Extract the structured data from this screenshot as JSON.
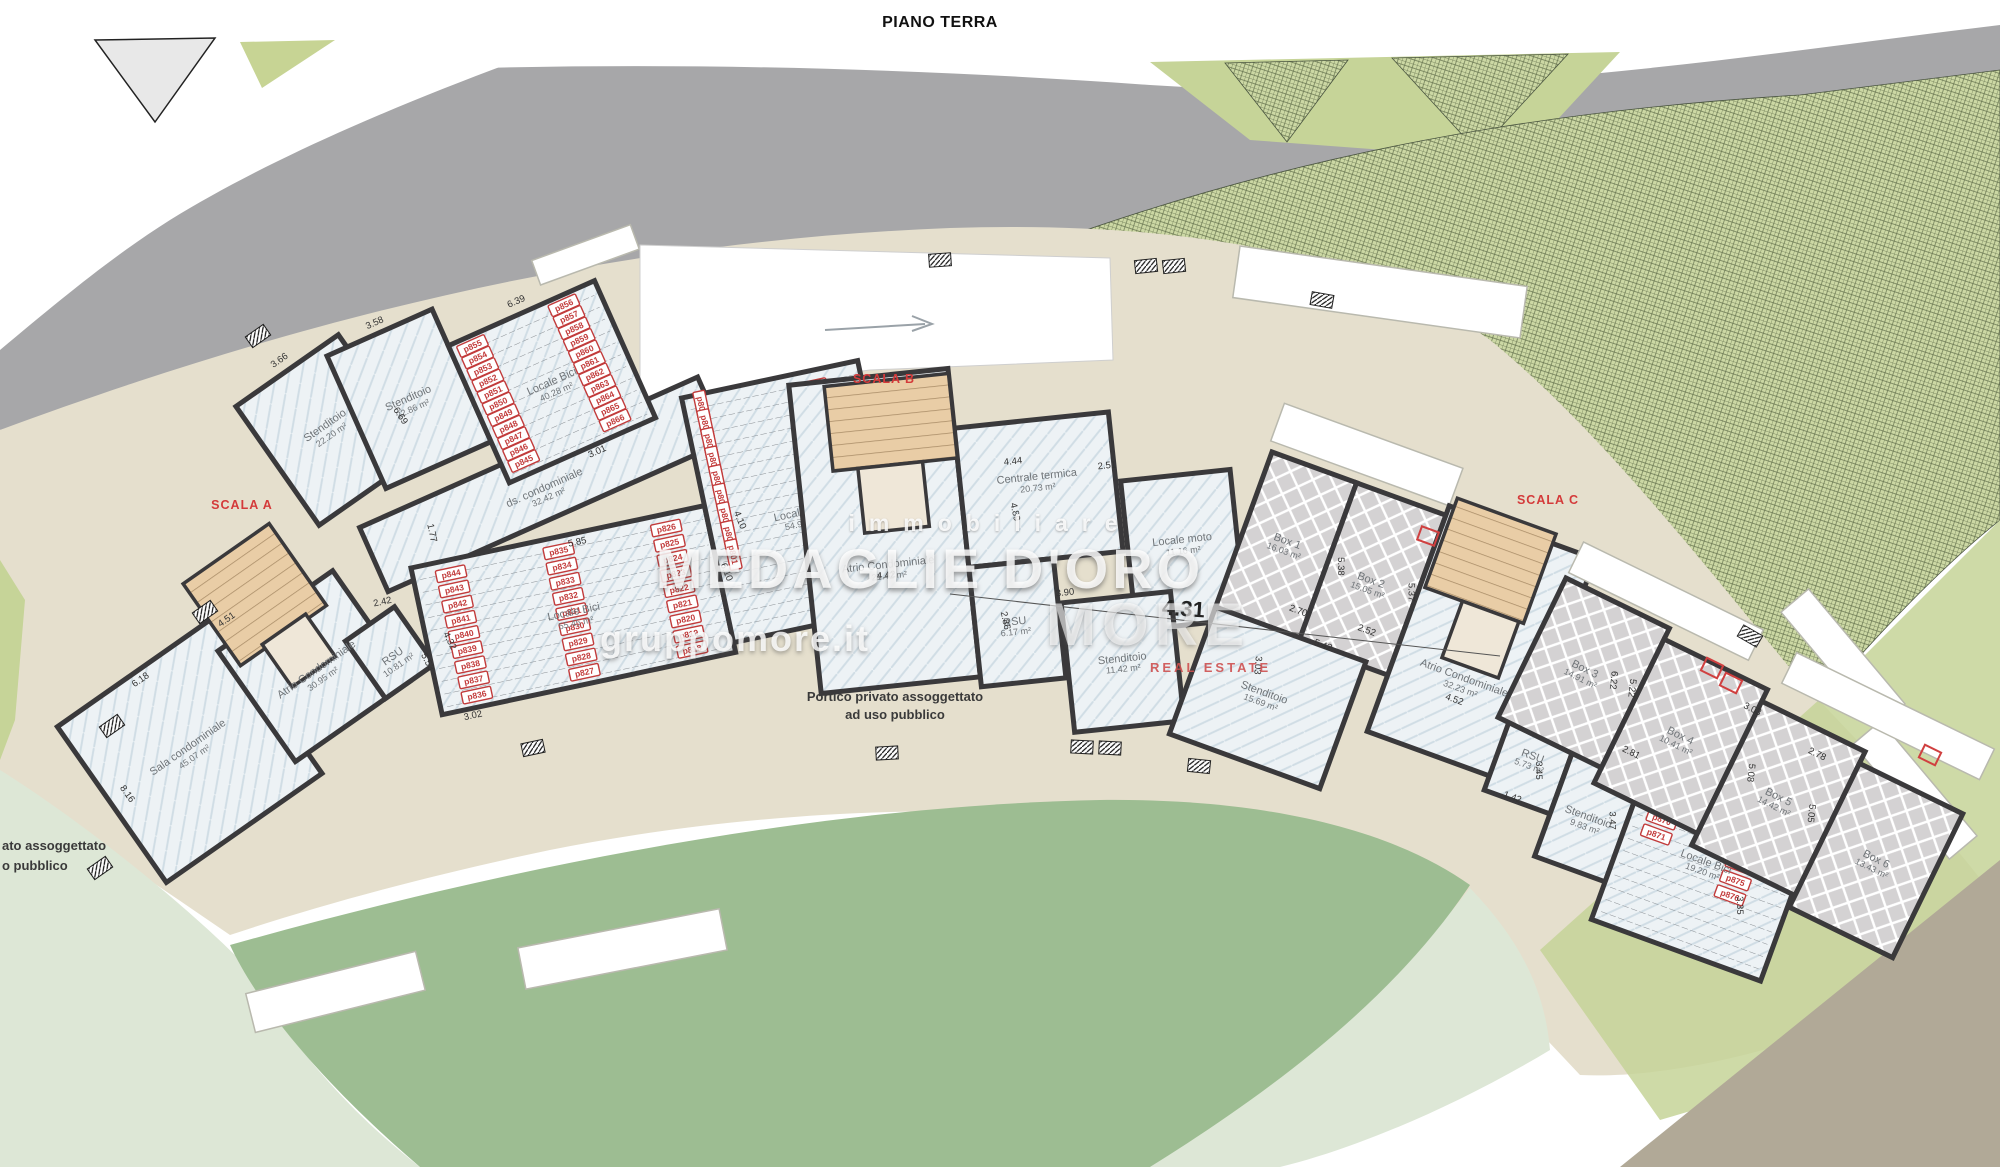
{
  "title": "PIANO TERRA",
  "stairwells": {
    "a": "SCALA A",
    "b": "SCALA B",
    "c": "SCALA C"
  },
  "watermark": {
    "immobiliare": "immobiliare",
    "brand": "MEDAGLIE D'ORO",
    "site": "gruppomore.it",
    "more": "MORE",
    "real_estate": "REAL ESTATE"
  },
  "annotations": {
    "portico_line1": "Portico privato assoggettato",
    "portico_line2": "ad uso pubblico",
    "edge_line1": "ato assoggettato",
    "edge_line2": "o pubblico",
    "big_dim": "4.31"
  },
  "colors": {
    "road_gray": "#a7a7a9",
    "lawn_light": "#dde7d6",
    "lawn_medium": "#9dbd92",
    "garden_green": "#ccd8a4",
    "pavement_tan": "#e5dfcd",
    "road_brown": "#b1a997",
    "wall": "#3a393b",
    "accent_red": "#d43a3a"
  },
  "rooms": {
    "sala": {
      "name": "Sala condominiale",
      "area": "45.07 m²"
    },
    "atrioA": {
      "name": "Atrio Condominiale",
      "area": "30.95 m²"
    },
    "rsu1081": {
      "name": "RSU",
      "area": "10.81 m²"
    },
    "stend2220": {
      "name": "Stenditoio",
      "area": "22.20 m²"
    },
    "stend2286": {
      "name": "Stenditoio",
      "area": "22.86 m²"
    },
    "bici4028": {
      "name": "Locale Bici",
      "area": "40.28 m²"
    },
    "dscond": {
      "name": "ds. condominiale",
      "area": "32.42 m²"
    },
    "bici5545": {
      "name": "Locale Bici",
      "area": "55.45 m²"
    },
    "bici5497": {
      "name": "Locale Bici",
      "area": "54.97 m²"
    },
    "atrioB": {
      "name": "Atrio Condominiale",
      "area": "21.42 m²"
    },
    "centrale": {
      "name": "Centrale termica",
      "area": "20.73 m²"
    },
    "moto": {
      "name": "Locale moto",
      "area": "11.16 m²"
    },
    "rsu617": {
      "name": "RSU",
      "area": "6.17 m²"
    },
    "stend1142": {
      "name": "Stenditoio",
      "area": "11.42 m²"
    },
    "box1": {
      "name": "Box 1",
      "area": "16.03 m²"
    },
    "box2": {
      "name": "Box 2",
      "area": "15.05 m²"
    },
    "atrioC": {
      "name": "Atrio Condominiale",
      "area": "32.23 m²"
    },
    "stend1569": {
      "name": "Stenditoio",
      "area": "15.69 m²"
    },
    "rsu573": {
      "name": "RSU",
      "area": "5.73 m²"
    },
    "stend983": {
      "name": "Stenditoio",
      "area": "9.83 m²"
    },
    "bici1920": {
      "name": "Locale Bici",
      "area": "19.20 m²"
    },
    "box3": {
      "name": "Box 3",
      "area": "14.91 m²"
    },
    "box4": {
      "name": "Box 4",
      "area": "10.41 m²"
    },
    "box5": {
      "name": "Box 5",
      "area": "14.42 m²"
    },
    "box6": {
      "name": "Box 6",
      "area": "13.43 m²"
    }
  },
  "dim_labels": {
    "l1a": [
      [
        "6.18",
        95,
        262,
        0
      ],
      [
        "8.16",
        16,
        345,
        90
      ],
      [
        "4.51",
        200,
        262,
        0
      ],
      [
        "3.66",
        392,
        80,
        0
      ]
    ],
    "l1b": [
      [
        "3.58",
        57,
        -8,
        0
      ],
      [
        "6.39",
        195,
        30,
        0
      ],
      [
        "3.01",
        208,
        200,
        0
      ],
      [
        "6.69",
        40,
        85,
        80
      ]
    ],
    "l2": [
      [
        "5.85",
        168,
        12,
        0
      ],
      [
        "3.02",
        30,
        160,
        0
      ],
      [
        "4.32",
        20,
        80,
        75
      ],
      [
        "5.53",
        -6,
        96,
        75
      ],
      [
        "2.42",
        -35,
        30,
        0
      ],
      [
        "1.77",
        25,
        -30,
        90
      ],
      [
        "4.10",
        329,
        22,
        80
      ],
      [
        "6.10",
        305,
        70,
        80
      ]
    ],
    "c": [
      [
        "4.44",
        215,
        62,
        0
      ],
      [
        "2.51",
        308,
        76,
        0
      ],
      [
        "4.89",
        209,
        110,
        84
      ],
      [
        "4.42",
        77,
        162,
        0
      ],
      [
        "3.90",
        253,
        198,
        0
      ],
      [
        "2.86",
        188,
        217,
        84
      ]
    ],
    "r1": [
      [
        "2.70",
        79,
        143,
        0
      ],
      [
        "2.52",
        150,
        138,
        0
      ],
      [
        "5.42",
        114,
        167,
        0
      ],
      [
        "3.03",
        57,
        206,
        75
      ],
      [
        "5.38",
        101,
        85,
        70
      ],
      [
        "5.37",
        176,
        85,
        70
      ],
      [
        "4.52",
        256,
        173,
        0
      ],
      [
        "2.73",
        362,
        150,
        0
      ],
      [
        "1.91",
        349,
        167,
        0
      ],
      [
        "3.45",
        357,
        209,
        70
      ],
      [
        "1.42",
        344,
        245,
        0
      ],
      [
        "2.92",
        419,
        185,
        0
      ],
      [
        "3.47",
        443,
        231,
        70
      ],
      [
        "2.55",
        514,
        191,
        0
      ],
      [
        "5.97",
        539,
        212,
        0
      ],
      [
        "2.54",
        585,
        207,
        0
      ],
      [
        "3.35",
        592,
        267,
        70
      ]
    ],
    "r2": [
      [
        "6.22",
        85,
        72,
        70
      ],
      [
        "5.22",
        105,
        71,
        70
      ],
      [
        "2.81",
        135,
        131,
        0
      ],
      [
        "3.03",
        225,
        39,
        0
      ],
      [
        "5.08",
        249,
        95,
        70
      ],
      [
        "2.78",
        303,
        51,
        0
      ],
      [
        "5.05",
        321,
        105,
        70
      ]
    ]
  },
  "parking_groups": [
    {
      "container": "bici40",
      "cols": [
        {
          "x": 22,
          "y": 10,
          "dy": 12.6,
          "labels": [
            "p855",
            "p854",
            "p853",
            "p852",
            "p851",
            "p850",
            "p849",
            "p848",
            "p847",
            "p846",
            "p845"
          ]
        },
        {
          "x": 122,
          "y": 10,
          "dy": 12.6,
          "labels": [
            "p856",
            "p857",
            "p858",
            "p859",
            "p860",
            "p861",
            "p862",
            "p863",
            "p864",
            "p865",
            "p866"
          ]
        }
      ]
    },
    {
      "container": "bici55",
      "cols": [
        {
          "x": 38,
          "y": 14,
          "dy": 15.5,
          "labels": [
            "p844",
            "p843",
            "p842",
            "p841",
            "p840",
            "p839",
            "p838",
            "p837",
            "p836"
          ]
        },
        {
          "x": 148,
          "y": 14,
          "dy": 15.5,
          "labels": [
            "p835",
            "p834",
            "p833",
            "p832",
            "p831",
            "p830",
            "p829",
            "p828",
            "p827"
          ]
        },
        {
          "x": 258,
          "y": 14,
          "dy": 15.5,
          "labels": [
            "p826",
            "p825",
            "p824",
            "p823",
            "p822",
            "p821",
            "p820",
            "p819",
            "p818"
          ]
        }
      ]
    },
    {
      "container": "bici54",
      "cols": [
        {
          "x": 18,
          "y": 12,
          "dy": 19,
          "rot": 90,
          "labels": [
            "p809",
            "p808",
            "p807",
            "p806",
            "p805",
            "p804",
            "p803",
            "p802",
            "p801"
          ]
        },
        {
          "x": 130,
          "y": 16,
          "dy": 17.5,
          "labels": [
            "p817",
            "p816",
            "p815",
            "p814",
            "p813",
            "p812",
            "p811",
            "p810"
          ]
        }
      ]
    },
    {
      "container": "bici19",
      "cols": [
        {
          "x": 32,
          "y": 14,
          "dy": 16,
          "labels": [
            "p867",
            "p868",
            "p869",
            "p870",
            "p871"
          ]
        },
        {
          "x": 122,
          "y": 46,
          "dy": 16,
          "labels": [
            "p872",
            "p873",
            "p874",
            "p875",
            "p876"
          ]
        }
      ]
    }
  ]
}
